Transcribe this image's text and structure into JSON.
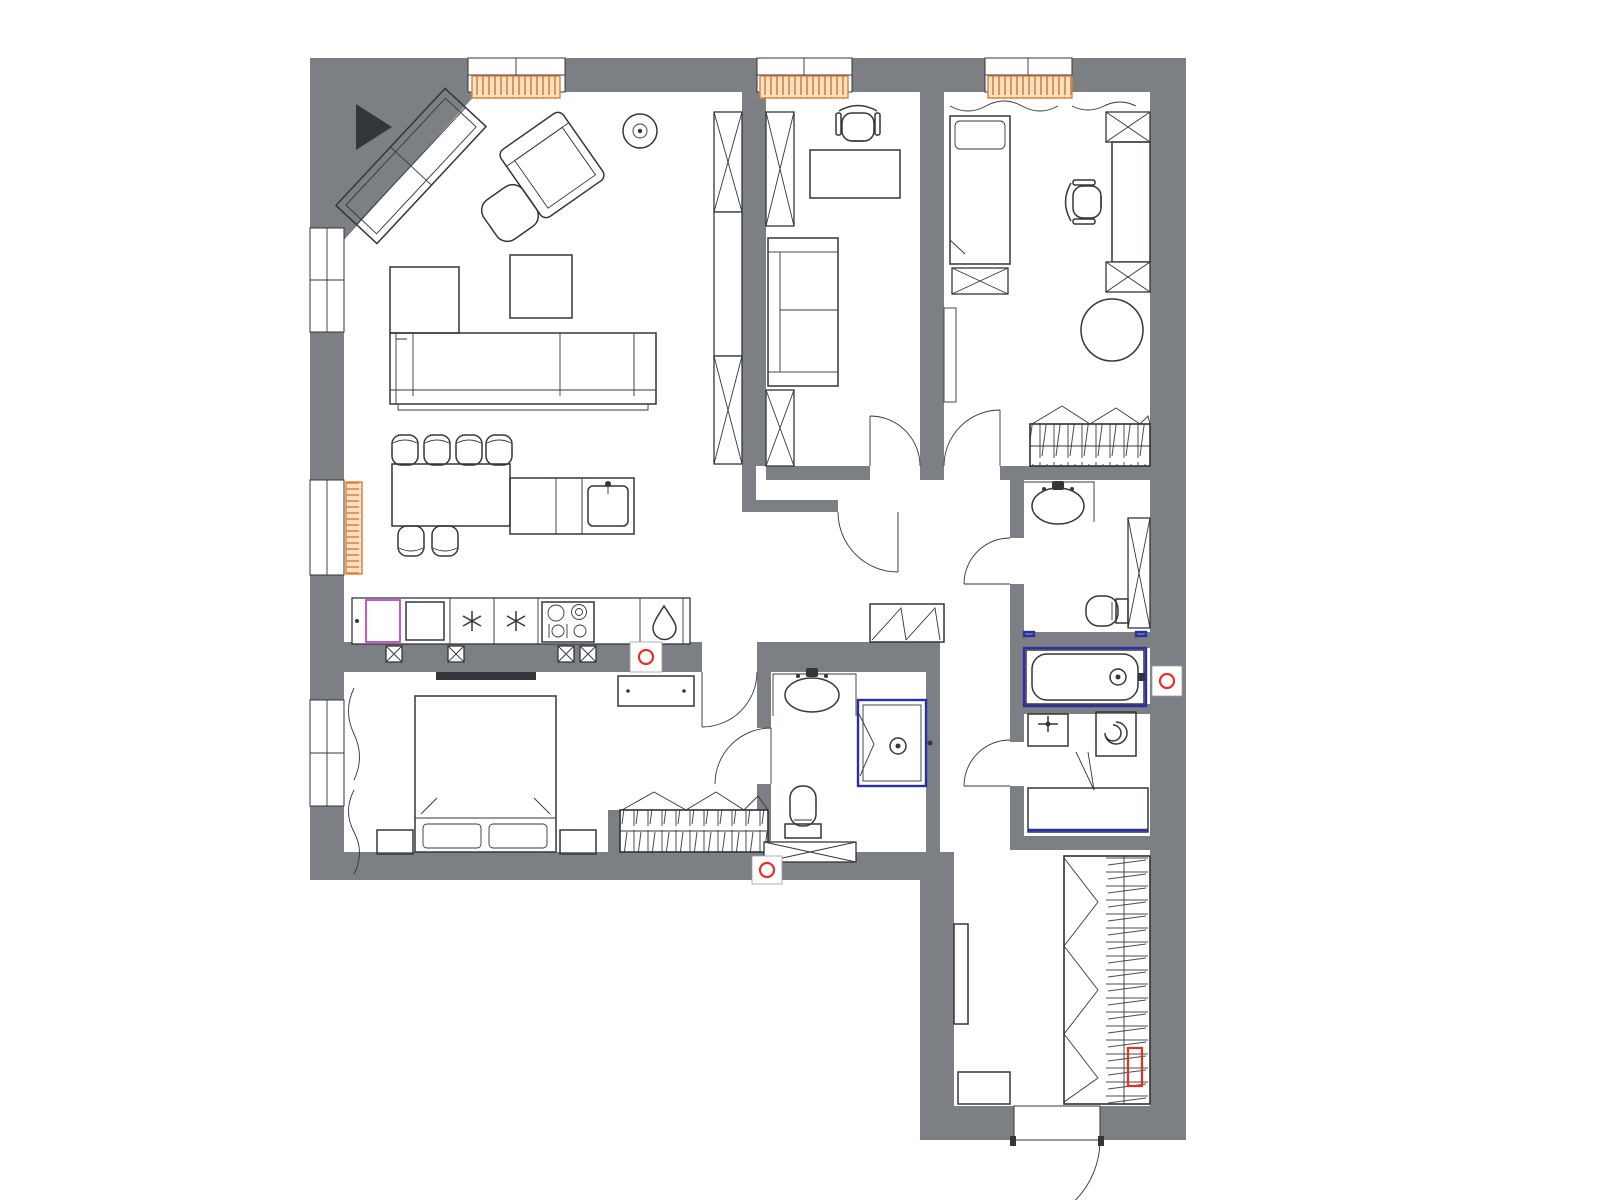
{
  "title": "apartment-floor-plan",
  "colors": {
    "paper": "#ffffff",
    "wall": "#7c7f83",
    "line": "#33363a",
    "radborder": "#d9813b",
    "radfill": "#f8e0c2",
    "red": "#e03227",
    "blue": "#2a2fa8",
    "magenta": "#c248c2"
  },
  "plan": {
    "rooms": [
      {
        "name": "living-room-kitchen",
        "furniture": [
          "corner-tv-unit",
          "tv-black-wedge",
          "ceiling-lamp",
          "armchair",
          "pouf",
          "coffee-table",
          "corner-sofa",
          "dining-table",
          "bar-stool",
          "kitchen-island",
          "island-sink",
          "dishwasher",
          "fridge",
          "freezer",
          "hob",
          "kitchen-sink"
        ]
      },
      {
        "name": "office",
        "furniture": [
          "desk",
          "desk-chair",
          "two-seat-sofa",
          "wardrobe-column"
        ]
      },
      {
        "name": "kids-bedroom",
        "furniture": [
          "curtain",
          "single-bed",
          "chest",
          "wall-shelf",
          "desk",
          "desk-chair",
          "round-rug",
          "open-wardrobe-hangers"
        ]
      },
      {
        "name": "master-bedroom",
        "furniture": [
          "curtain",
          "double-bed",
          "nightstand",
          "dresser",
          "wall-tv",
          "open-wardrobe-hangers"
        ]
      },
      {
        "name": "ensuite-bathroom",
        "furniture": [
          "vanity-washbasin",
          "shower-cabin",
          "toilet",
          "wall-cabinet"
        ]
      },
      {
        "name": "family-bathroom",
        "furniture": [
          "vanity-washbasin",
          "toilet",
          "tall-cabinet"
        ]
      },
      {
        "name": "bath-niche",
        "furniture": [
          "bathtub",
          "drain-mark"
        ]
      },
      {
        "name": "laundry-room",
        "furniture": [
          "utility-sink",
          "washing-machine",
          "counter"
        ]
      },
      {
        "name": "entrance-hall",
        "furniture": [
          "open-wardrobe-hangers",
          "mirror",
          "bench",
          "shoe-cabinet",
          "entrance-door"
        ]
      }
    ],
    "symbols": {
      "window-count": 6,
      "radiator-count": 4,
      "floor-drain-marks": [
        "kitchen-wall",
        "ensuite-wall",
        "bath-wall-right"
      ],
      "electric-panel": "hall-wardrobe-red-box",
      "outlet-marks": "kitchen-back-wall"
    }
  }
}
